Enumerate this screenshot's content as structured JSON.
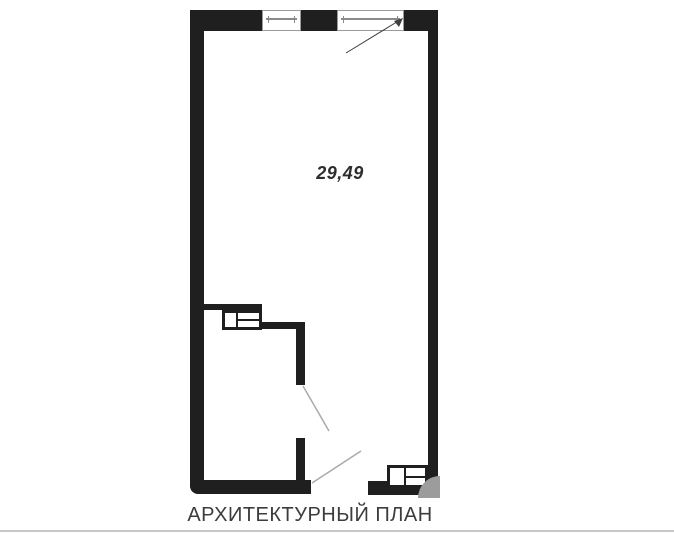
{
  "plan": {
    "area_value": "29,49",
    "caption": "АРХИТЕКТУРНЫЙ ПЛАН"
  },
  "colors": {
    "background": "#ffffff",
    "wall": "#1f1f1f",
    "window_outline": "#9a9a9a",
    "window_pane_line": "#8a8a8a",
    "door_swing_line": "#aaaaaa",
    "leader_line": "#3f3f3f",
    "area_text": "#2e2e2e",
    "caption_text": "#3c3c3c",
    "footer_divider": "#c8c8c8",
    "corner_shade": "#9c9c9c"
  }
}
